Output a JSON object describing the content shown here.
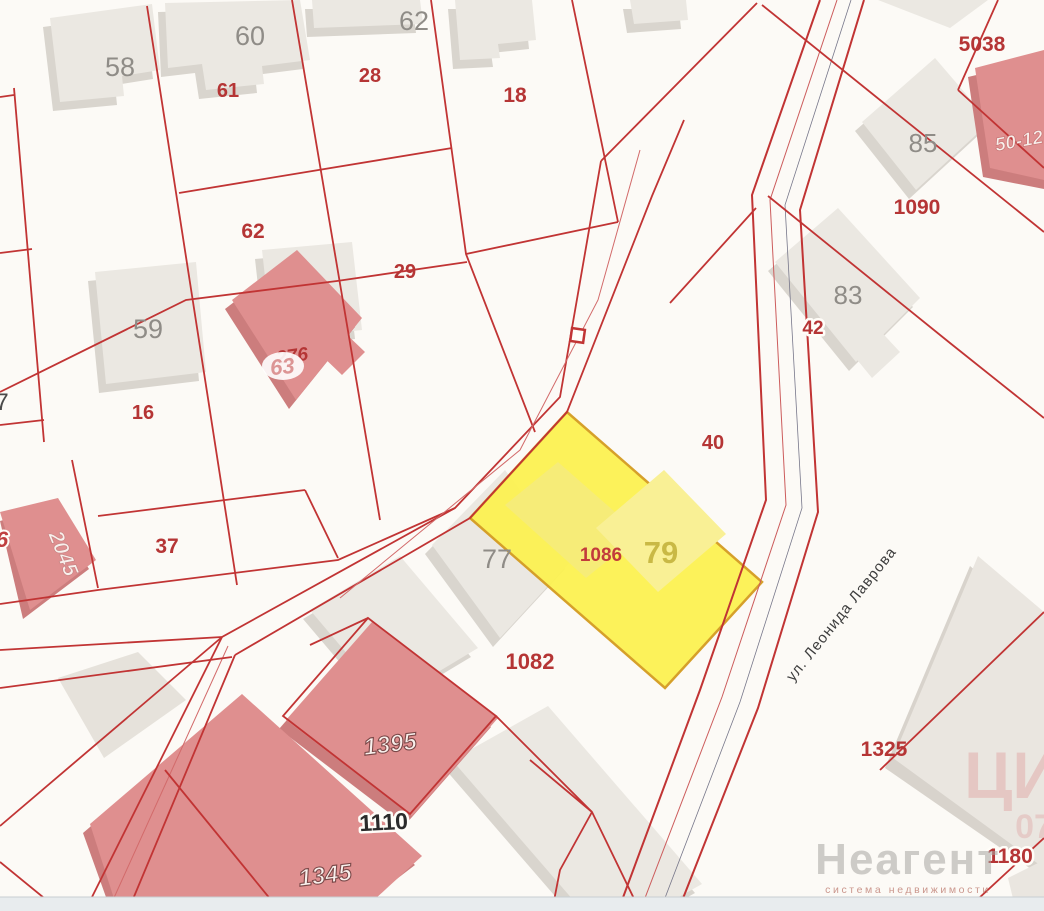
{
  "map": {
    "background": "#fcfaf6",
    "line_color": "#c13434",
    "selected": {
      "parcel_number": "1086",
      "building_number": "79",
      "fill": "#fcf252",
      "border": "#d49c20"
    },
    "street": {
      "name": "ул. Леонида Лаврова"
    },
    "marker": {
      "name": "square-poi-marker"
    },
    "building_labels": {
      "b7": "7",
      "b58": "58",
      "b60": "60",
      "b62": "62",
      "b59": "59",
      "b77": "77",
      "b83": "83",
      "b85": "85"
    },
    "parcel_labels": {
      "p61": "61",
      "p28": "28",
      "p18": "18",
      "p62": "62",
      "p29": "29",
      "p16": "16",
      "p276": "276",
      "p37": "37",
      "p40": "40",
      "p42": "42",
      "p1090": "1090",
      "p5038": "5038",
      "p1082": "1082",
      "p1325": "1325",
      "p1180": "1180"
    },
    "house_labels": {
      "h63": "63",
      "h6": "6",
      "h2045": "2045",
      "h5012": "50-12",
      "h1395": "1395",
      "h1110": "1110",
      "h1345": "1345"
    },
    "watermark": {
      "title": "Неагент",
      "subtitle": "система недвижимости",
      "corner_top": "ЦИ",
      "corner_bottom": "07"
    }
  }
}
